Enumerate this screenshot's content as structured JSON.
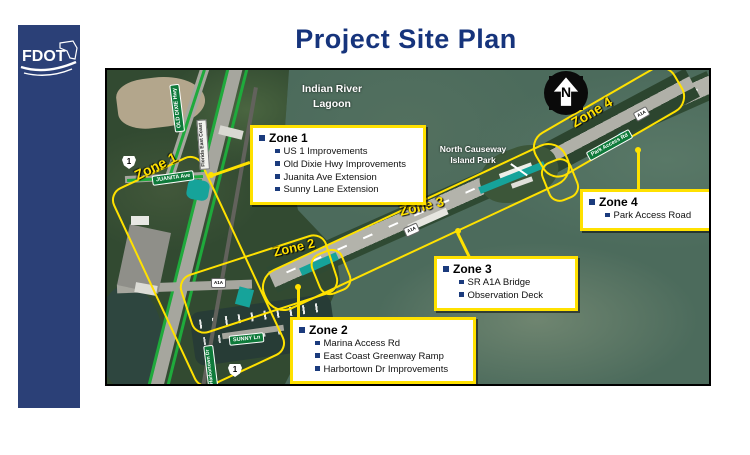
{
  "slide": {
    "title": "Project Site Plan",
    "logo": "FDOT"
  },
  "map": {
    "lagoon_label_line1": "Indian River",
    "lagoon_label_line2": "Lagoon",
    "park_label_line1": "North Causeway",
    "park_label_line2": "Island Park",
    "north_letter": "N",
    "zone_labels": [
      "Zone 1",
      "Zone 2",
      "Zone 3",
      "Zone 4"
    ],
    "signs": {
      "us_route": "1",
      "a1a": "A1A",
      "old_dixie": "OLD DIXIE Hwy",
      "juanita": "JUANITA Ave",
      "sunny": "SUNNY Ln",
      "park_access": "Park Access Rd",
      "harbortown": "Harbortown Dr",
      "railroad": "Florida East Coast"
    }
  },
  "callouts": [
    {
      "title": "Zone 1",
      "items": [
        "US 1 Improvements",
        "Old Dixie Hwy Improvements",
        "Juanita Ave Extension",
        "Sunny Lane Extension"
      ]
    },
    {
      "title": "Zone 2",
      "items": [
        "Marina Access Rd",
        "East Coast Greenway Ramp",
        "Harbortown Dr Improvements"
      ]
    },
    {
      "title": "Zone 3",
      "items": [
        "SR A1A Bridge",
        "Observation Deck"
      ]
    },
    {
      "title": "Zone 4",
      "items": [
        "Park Access Road"
      ]
    }
  ],
  "colors": {
    "accent_yellow": "#FFE100",
    "title_navy": "#16347C",
    "sidebar_blue": "#2B4077",
    "bullet_navy": "#1B3B7D",
    "highlight_teal": "#16A39A",
    "improvement_green": "#1FAA3C"
  }
}
